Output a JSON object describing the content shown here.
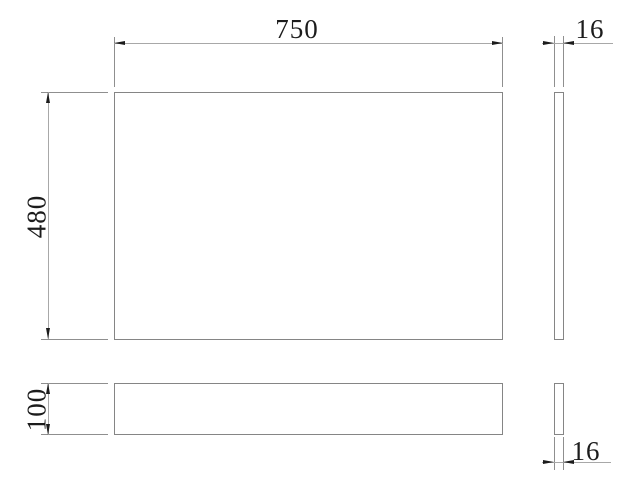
{
  "drawing": {
    "dimensions": {
      "panel_width": "750",
      "panel_height": "480",
      "panel_thickness": "16",
      "plinth_height": "100",
      "plinth_thickness": "16"
    },
    "colors": {
      "outline": "#858585",
      "ext_line": "#8f8f8f",
      "dim_line": "#a8a8a8",
      "arrow": "#1c1c1c",
      "text": "#1c1c1c",
      "background": "#ffffff"
    }
  }
}
